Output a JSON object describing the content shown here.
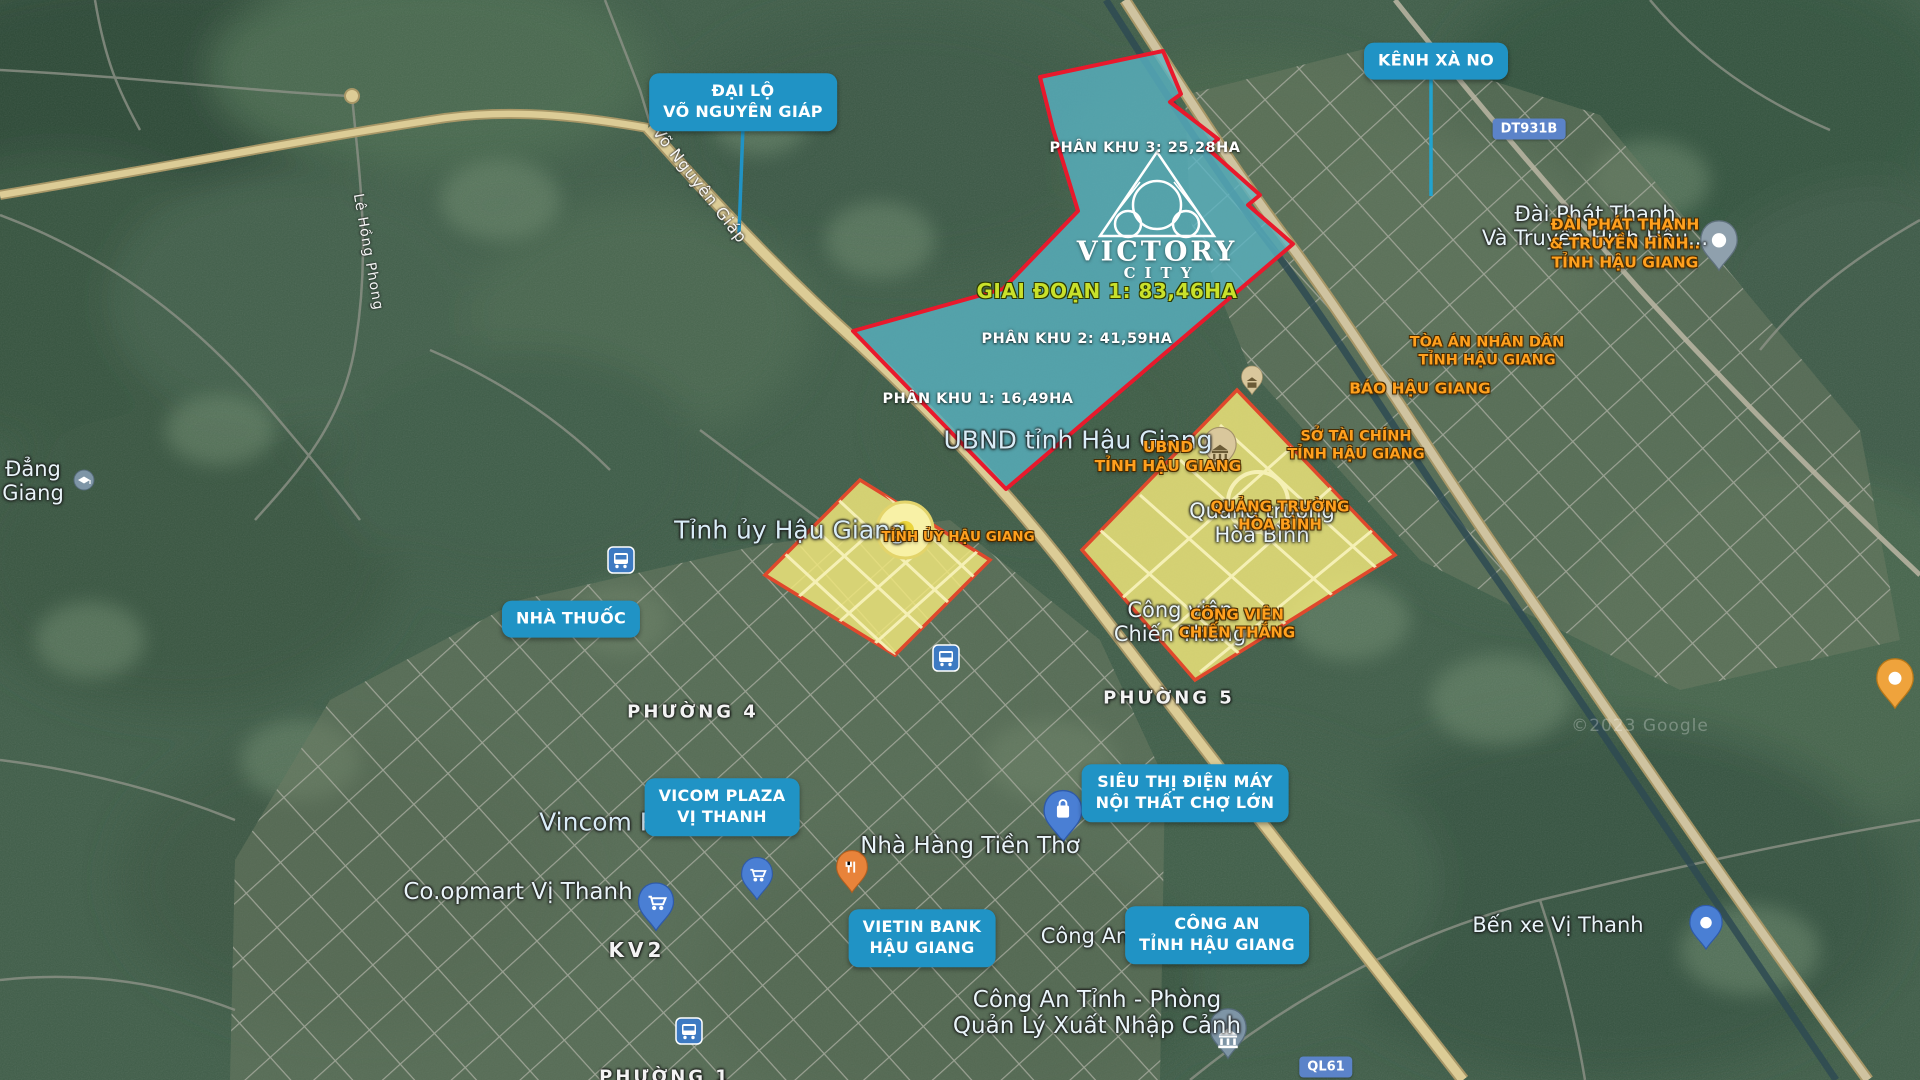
{
  "project": {
    "brand": {
      "top": "VICTORY",
      "bottom": "CITY"
    },
    "phase1_label": "GIAI ĐOẠN 1: 83,46HA",
    "subzones": [
      {
        "label": "PHÂN KHU 3: 25,28HA"
      },
      {
        "label": "PHÂN KHU 2: 41,59HA"
      },
      {
        "label": "PHÂN KHU 1: 16,49HA"
      }
    ]
  },
  "callouts": {
    "dai_lo": {
      "lines": [
        "ĐẠI LỘ",
        "VÕ NGUYÊN GIÁP"
      ]
    },
    "kenh_xa_no": {
      "label": "KÊNH XÀ NO"
    },
    "nha_thuoc": {
      "label": "NHÀ THUỐC"
    },
    "vicom_plaza": {
      "lines": [
        "VICOM PLAZA",
        "VỊ THANH"
      ]
    },
    "sieu_thi": {
      "lines": [
        "SIÊU THỊ ĐIỆN MÁY",
        "NỘI THẤT CHỢ LỚN"
      ]
    },
    "vietin_bank": {
      "lines": [
        "VIETIN BANK",
        "HẬU GIANG"
      ]
    },
    "cong_an": {
      "lines": [
        "CÔNG AN",
        "TỈNH HẬU GIANG"
      ]
    }
  },
  "poi_orange": {
    "dai_phat_thanh": {
      "lines": [
        "ĐÀI PHÁT THANH",
        "& TRUYỀN HÌNH..",
        "TỈNH HẬU GIANG"
      ]
    },
    "toa_an": {
      "lines": [
        "TÒA ÁN NHÂN DÂN",
        "TỈNH HẬU GIANG"
      ]
    },
    "bao_hau_giang": {
      "label": "BÁO HẬU GIANG"
    },
    "so_tai_chinh": {
      "lines": [
        "SỞ TÀI CHÍNH",
        "TỈNH HẬU GIANG"
      ]
    },
    "ubnd": {
      "lines": [
        "UBND",
        "TỈNH HẬU GIANG"
      ]
    },
    "quang_truong": {
      "lines": [
        "QUẢNG TRƯỜNG",
        "HÒA BÌNH"
      ]
    },
    "cong_vien": {
      "lines": [
        "CÔNG VIÊN",
        "CHIẾN THẮNG"
      ]
    },
    "tinh_uy": {
      "label": "TỈNH ỦY HẬU GIANG"
    }
  },
  "map_labels": {
    "ubnd_tinh": "UBND tỉnh Hậu Giang",
    "tinh_uy": "Tỉnh ủy Hậu Giang",
    "dai_pt": {
      "lines": [
        "Đài Phát Thanh",
        "Và Truyền Hình Hậu..."
      ]
    },
    "quang_truong": {
      "lines": [
        "Quảng trường",
        "Hòa Bình"
      ]
    },
    "cong_vien": {
      "lines": [
        "Công viên",
        "Chiến Thắng"
      ]
    },
    "vincom": "Vincom P",
    "coopmart": "Co.opmart Vị Thanh",
    "nha_hang": "Nhà Hàng Tiền Thơ",
    "ben_xe": "Bến xe Vị Thanh",
    "cong_an": "Công An",
    "cong_an_phong": {
      "lines": [
        "Công An Tỉnh - Phòng",
        "Quản Lý Xuất Nhập Cảnh"
      ]
    },
    "dang_giang": {
      "lines": [
        "Đẳng",
        "Giang"
      ]
    },
    "watermark": "©2023 Google",
    "wards": {
      "p4": "PHƯỜNG 4",
      "p5": "PHƯỜNG 5",
      "p1": "PHƯỜNG 1",
      "kv2": "KV2"
    },
    "streets": {
      "vo_nguyen_giap": "Võ Nguyên Giáp",
      "le_hong_phong": "Lê Hồng Phong"
    },
    "road_badges": {
      "dt931b": "DT931B",
      "ql61": "QL61"
    }
  },
  "icons": {
    "bus": "bus-icon",
    "shopping_cart": "shopping-cart-pin-icon",
    "shopping_bag": "shopping-bag-pin-icon",
    "restaurant": "restaurant-pin-icon",
    "government": "government-building-pin-icon",
    "place": "place-pin-icon",
    "school": "school-pin-icon"
  },
  "colors": {
    "callout_bg": "#2093c5",
    "orange_poi": "#ffa01e",
    "project_fill": "#58b4c4",
    "project_border": "#e8192c",
    "zone_fill": "#f3e97b",
    "zone_border": "#e0482c",
    "phase_text": "#c9e12b",
    "road_badge_bg": "#5b83c9"
  }
}
